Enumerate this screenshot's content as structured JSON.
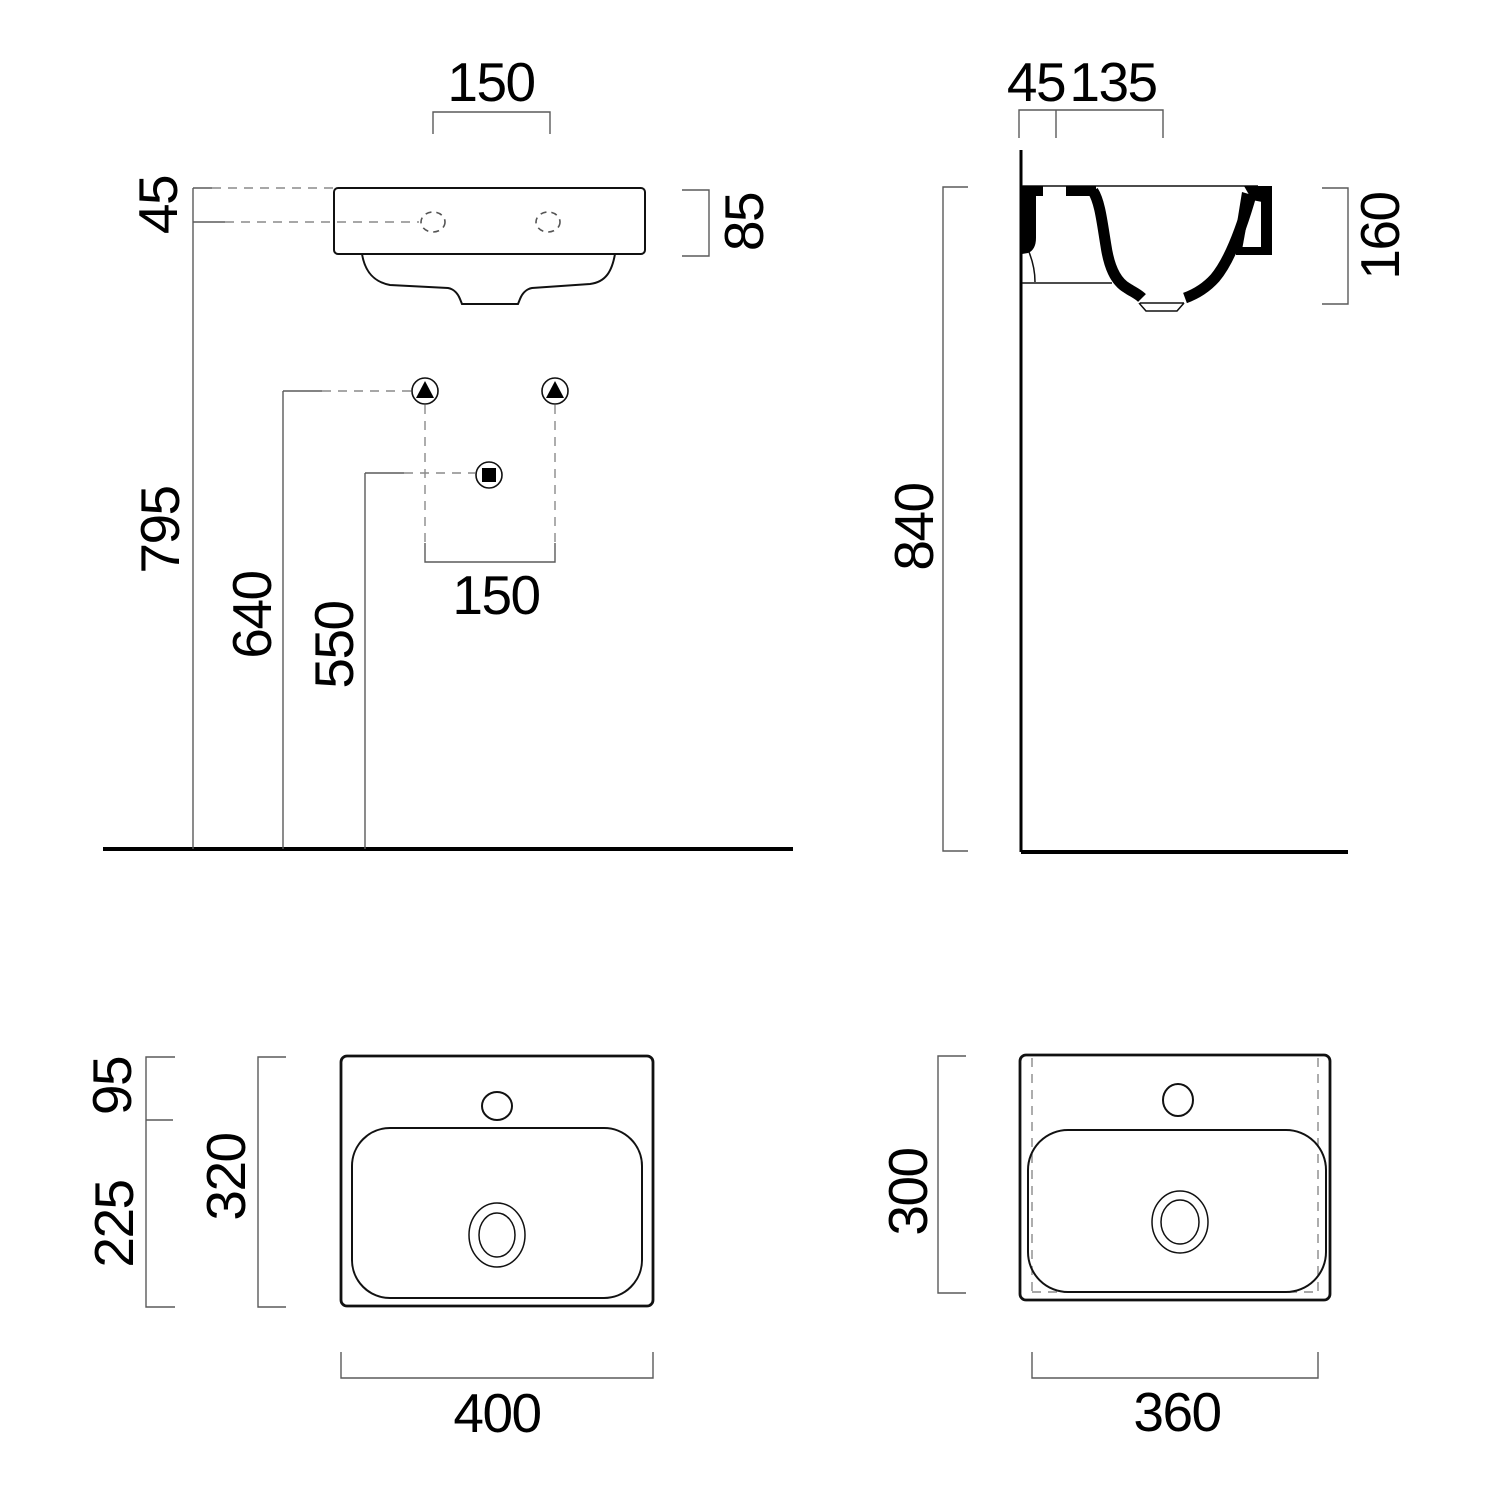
{
  "drawing": {
    "front_view": {
      "tap_spacing": "150",
      "rim_to_tap_axis": "45",
      "apron_height": "85",
      "rim_height": "795",
      "supply_height": "640",
      "waste_height": "550",
      "supply_spacing": "150"
    },
    "side_view": {
      "wall_to_tap": "45",
      "tap_to_waste": "135",
      "basin_depth": "160",
      "rim_height": "840"
    },
    "plan_top_view": {
      "deck_depth": "95",
      "bowl_depth": "225",
      "overall_depth": "320",
      "overall_width": "400"
    },
    "plan_bottom_view": {
      "overall_depth": "300",
      "overall_width": "360"
    }
  }
}
